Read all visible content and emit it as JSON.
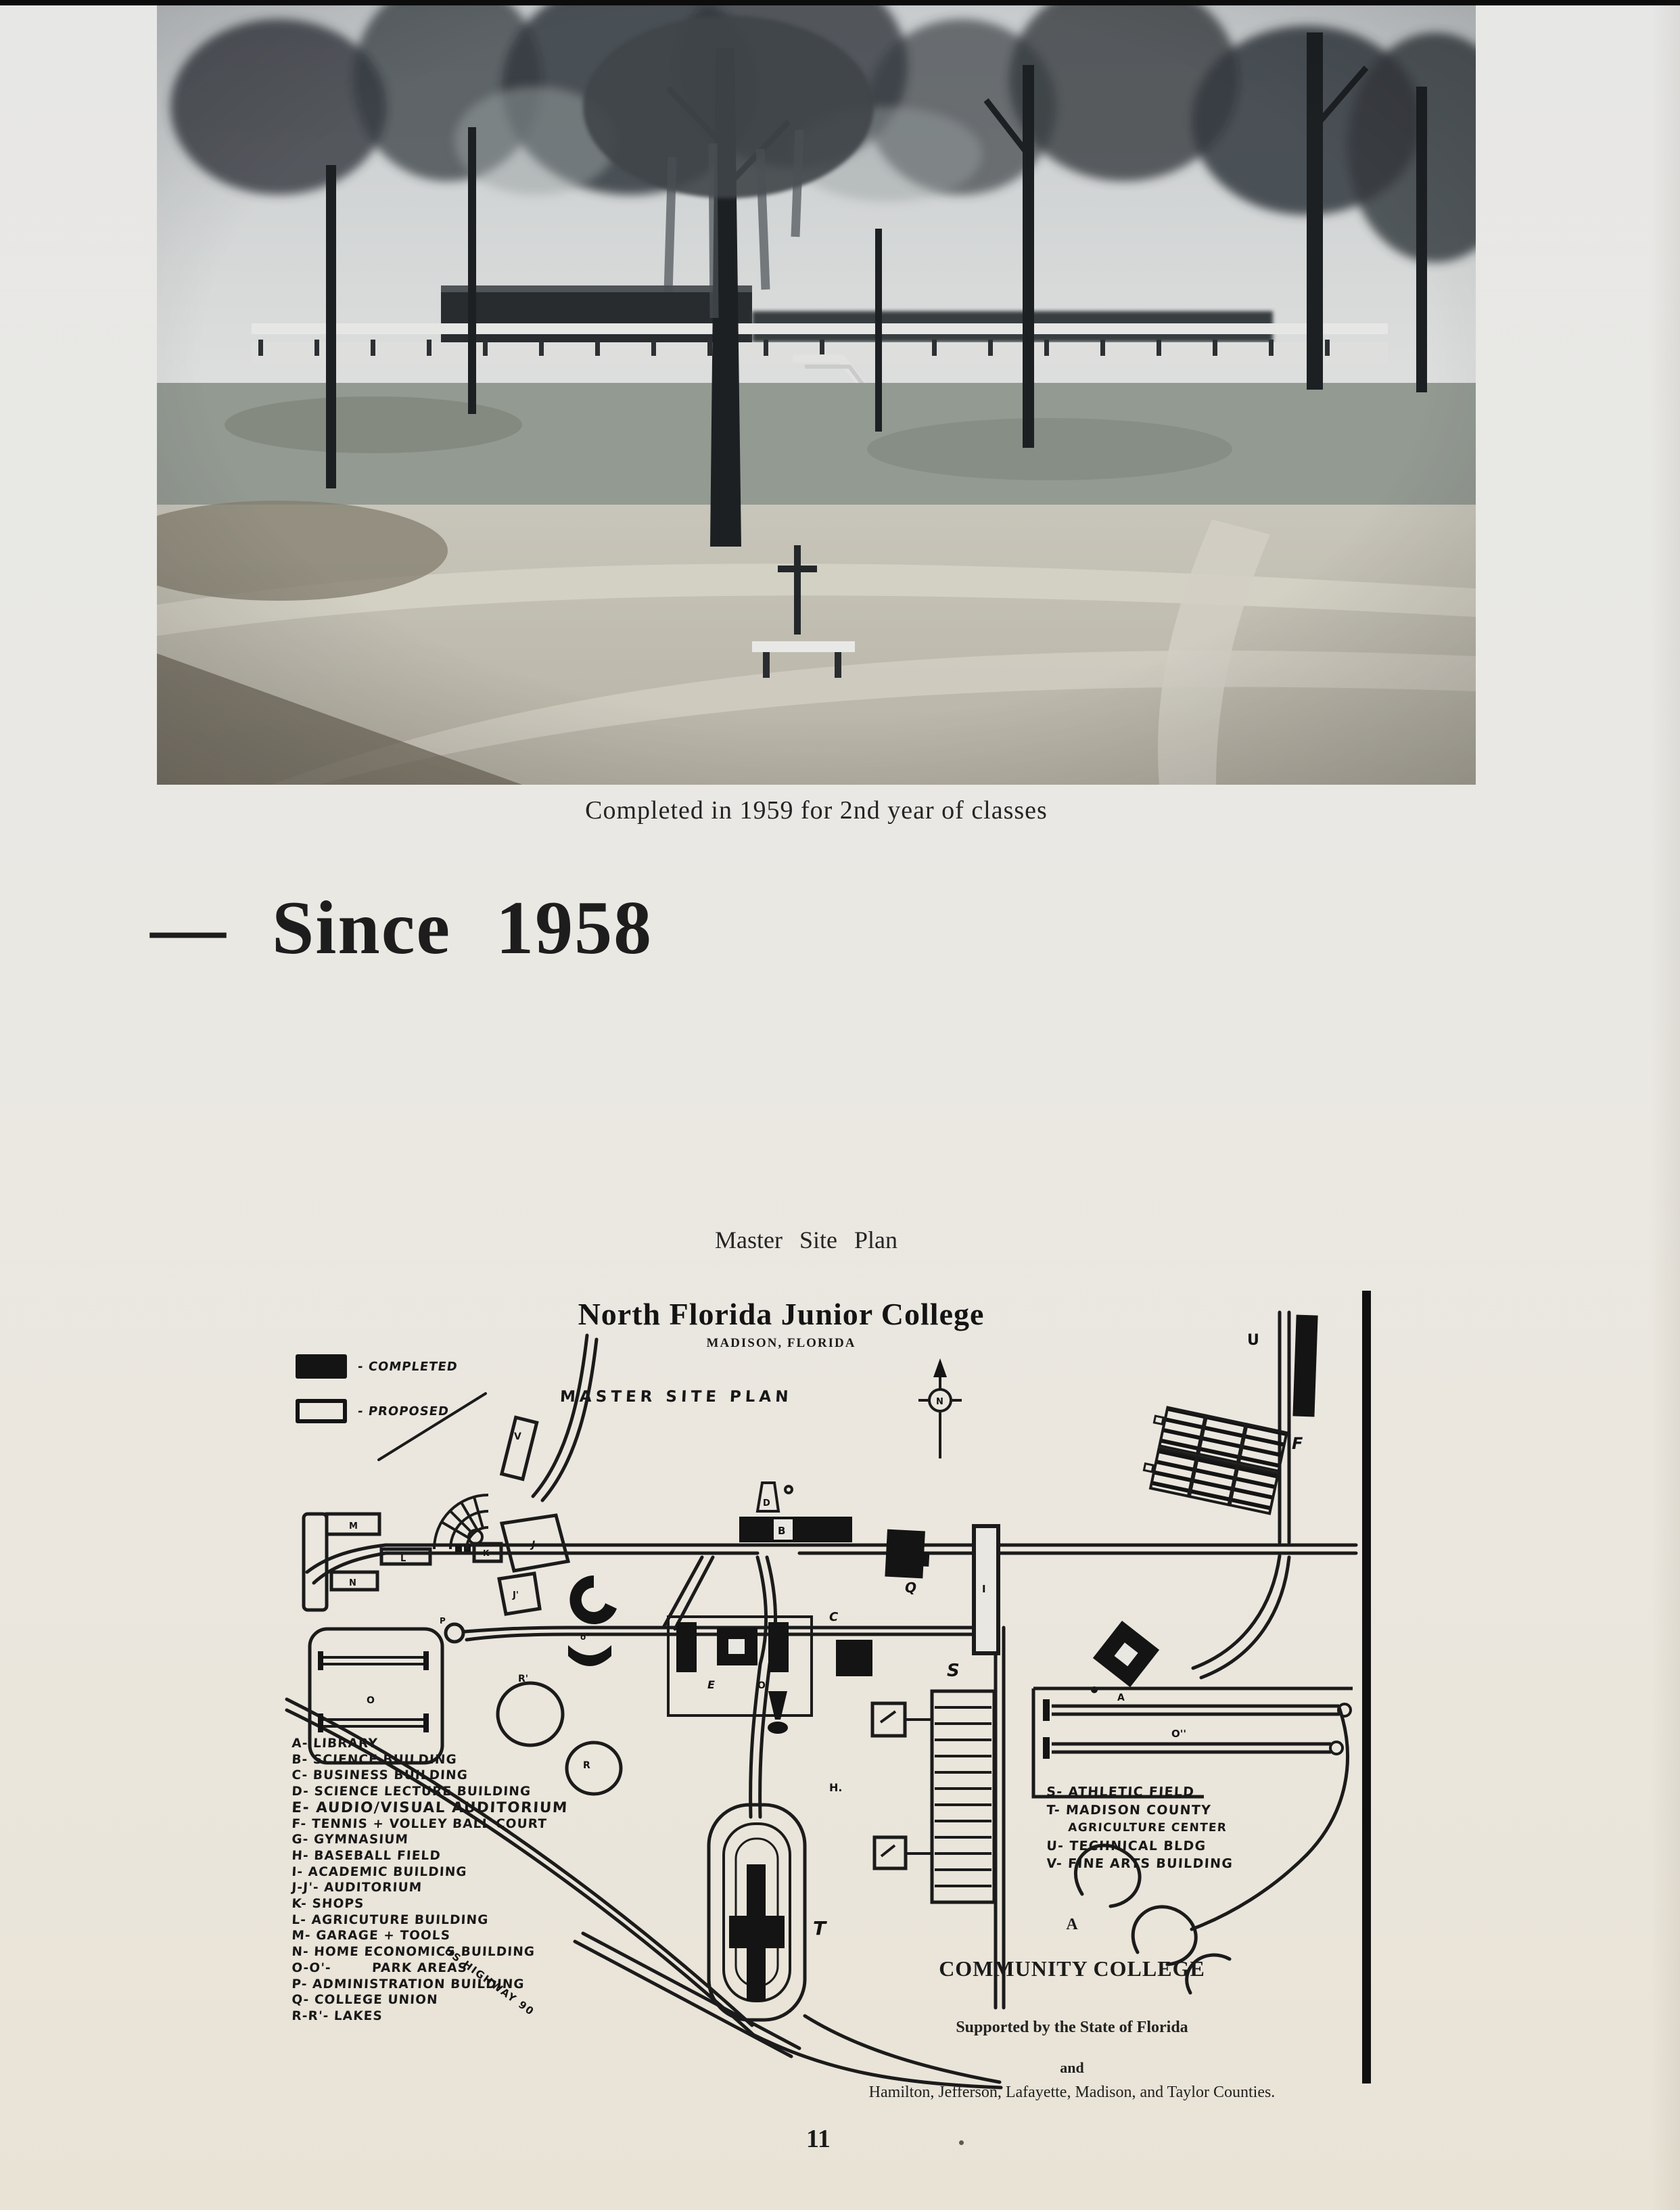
{
  "page": {
    "photo_caption": "Completed in 1959 for 2nd year of classes",
    "heading": "— Since 1958",
    "map_caption": "Master Site Plan",
    "page_number": "11"
  },
  "site_plan": {
    "title": "North Florida Junior College",
    "subtitle": "MADISON, FLORIDA",
    "plan_label": "MASTER SITE PLAN",
    "compass_label": "N",
    "road_label": "US HIGHWAY 90",
    "legend_key": {
      "completed": "- COMPLETED",
      "proposed": "- PROPOSED"
    },
    "legend_left": [
      "A- LIBRARY",
      "B- SCIENCE BUILDING",
      "C- BUSINESS BUILDING",
      "D- SCIENCE LECTURE BUILDING",
      "E- AUDIO/VISUAL AUDITORIUM",
      "F- TENNIS + VOLLEY BALL COURT",
      "G- GYMNASIUM",
      "H- BASEBALL FIELD",
      "I- ACADEMIC BUILDING",
      "J-J'- AUDITORIUM",
      "K- SHOPS",
      "L- AGRICUTURE BUILDING",
      "M- GARAGE + TOOLS",
      "N- HOME ECONOMICS BUILDING",
      "O-O'-        PARK AREAS",
      "P- ADMINISTRATION BUILDING",
      "Q- COLLEGE UNION",
      "R-R'- LAKES"
    ],
    "legend_right": [
      "S- ATHLETIC FIELD",
      "T- MADISON COUNTY",
      "AGRICULTURE CENTER",
      "U- TECHNICAL BLDG",
      "V- FINE ARTS BUILDING"
    ],
    "labels": {
      "v": "V",
      "m": "M",
      "l": "L",
      "n": "N",
      "k": "K",
      "j": "J",
      "j2": "J'",
      "d": "D",
      "b": "B",
      "q": "Q",
      "i": "I",
      "c": "C",
      "e": "E",
      "o1": "O'",
      "g_mark": "o°",
      "a": "A",
      "f": "F",
      "u": "U",
      "s": "S",
      "h": "H.",
      "t": "T",
      "o2": "O''",
      "o": "O",
      "r": "R",
      "r2": "R'",
      "p": "P"
    },
    "footer": {
      "a": "A",
      "name": "COMMUNITY COLLEGE",
      "support": "Supported by the State of Florida",
      "and": "and",
      "counties": "Hamilton, Jefferson, Lafayette, Madison, and Taylor Counties."
    },
    "colors": {
      "ink": "#1b1b1b",
      "paper": "#e9e7e2"
    }
  }
}
